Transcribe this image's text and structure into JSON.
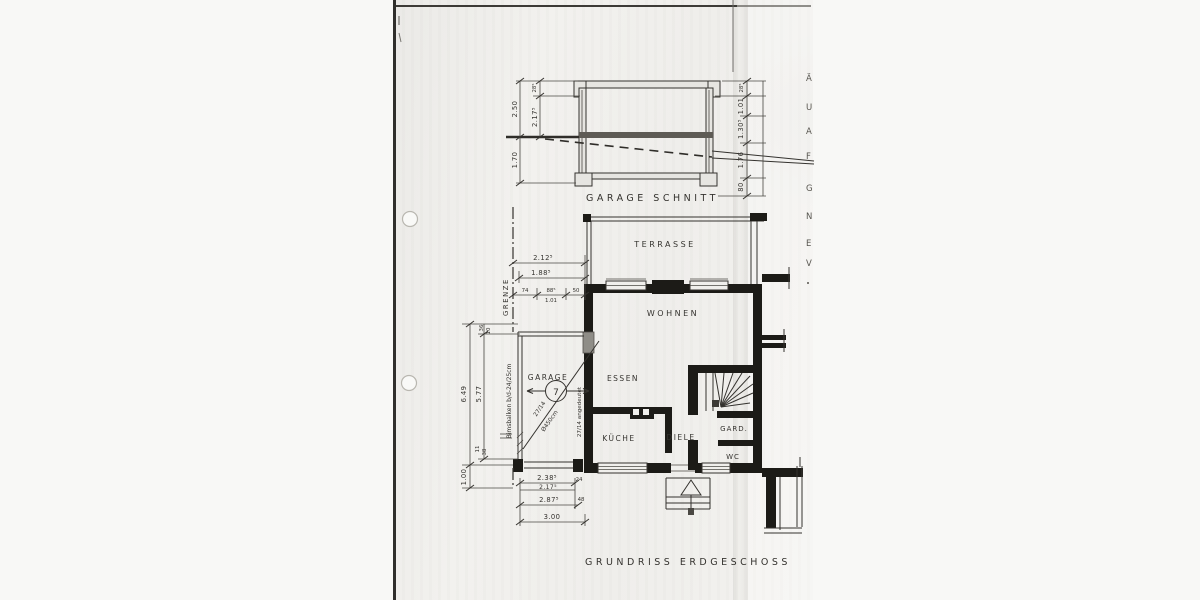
{
  "titles": {
    "section": "GARAGE SCHNITT",
    "plan": "GRUNDRISS ERDGESCHOSS"
  },
  "rooms": {
    "terrasse": "TERRASSE",
    "wohnen": "WOHNEN",
    "essen": "ESSEN",
    "kueche": "KÜCHE",
    "diele": "DIELE",
    "gard": "GARD.",
    "wc": "WC",
    "garage": "GARAGE"
  },
  "plan_annotations": {
    "position_number": "7",
    "boundary": "GRENZE",
    "beam_note": "Bimsbalken b/d-24/25cm",
    "wall_note": "27/14 angedeutet",
    "diag_note_a": "27/14",
    "diag_note_b": "Ø450cm"
  },
  "section_dims": {
    "left": [
      "28⁵",
      "2.50",
      "2.17⁵",
      "1.70"
    ],
    "right": [
      "28⁵",
      "1.01",
      "1.30⁵",
      "1.76",
      "80"
    ]
  },
  "plan_dims": {
    "top": [
      "2.12⁵",
      "1.88⁵",
      "74",
      "88⁵",
      "1.01",
      "50"
    ],
    "left": [
      "6.49",
      "5.77",
      "36",
      "10",
      "11",
      "38",
      "1.00"
    ],
    "bottom": [
      "2.38⁵",
      "2.17⁵",
      "24",
      "2.87⁵",
      "48",
      "3.00"
    ]
  },
  "edge_letters": [
    "Ä",
    "U",
    "A",
    "F",
    "G",
    "N",
    "E",
    "V"
  ]
}
